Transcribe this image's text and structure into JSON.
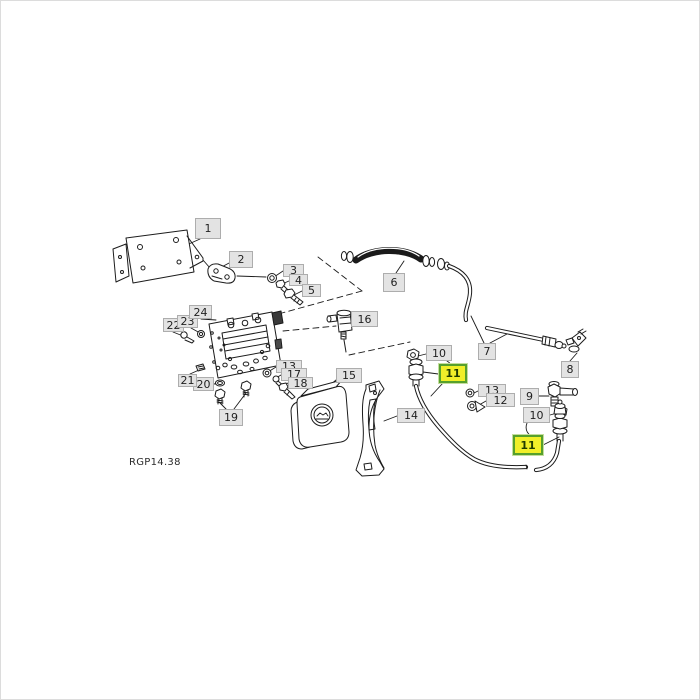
{
  "figure": {
    "code": "RGP14.38",
    "type": "exploded-parts-diagram",
    "colors": {
      "line": "#1c1c1c",
      "label_bg": "#e3e3e3",
      "label_border": "#adadad",
      "label_text": "#1f1f1f",
      "highlight_bg": "#f1ef29",
      "highlight_border": "#56a02c",
      "highlight_halo": "#c4dd9d",
      "highlight_text": "#1e3b00"
    },
    "labels": [
      {
        "text": "1",
        "x": 195,
        "y": 218,
        "w": 26,
        "h": 21,
        "highlighted": false
      },
      {
        "text": "2",
        "x": 229,
        "y": 251,
        "w": 24,
        "h": 17,
        "highlighted": false
      },
      {
        "text": "3",
        "x": 283,
        "y": 264,
        "w": 21,
        "h": 13,
        "highlighted": false
      },
      {
        "text": "4",
        "x": 289,
        "y": 274,
        "w": 19,
        "h": 12,
        "highlighted": false
      },
      {
        "text": "5",
        "x": 302,
        "y": 284,
        "w": 19,
        "h": 13,
        "highlighted": false
      },
      {
        "text": "6",
        "x": 383,
        "y": 273,
        "w": 22,
        "h": 19,
        "highlighted": false
      },
      {
        "text": "7",
        "x": 478,
        "y": 343,
        "w": 18,
        "h": 17,
        "highlighted": false
      },
      {
        "text": "8",
        "x": 561,
        "y": 361,
        "w": 18,
        "h": 17,
        "highlighted": false
      },
      {
        "text": "9",
        "x": 520,
        "y": 388,
        "w": 19,
        "h": 17,
        "highlighted": false
      },
      {
        "text": "10",
        "x": 426,
        "y": 345,
        "w": 26,
        "h": 16,
        "highlighted": false
      },
      {
        "text": "11",
        "x": 439,
        "y": 364,
        "w": 28,
        "h": 19,
        "highlighted": true
      },
      {
        "text": "13",
        "x": 478,
        "y": 384,
        "w": 28,
        "h": 13,
        "highlighted": false
      },
      {
        "text": "12",
        "x": 486,
        "y": 393,
        "w": 29,
        "h": 14,
        "highlighted": false
      },
      {
        "text": "10",
        "x": 523,
        "y": 407,
        "w": 27,
        "h": 16,
        "highlighted": false
      },
      {
        "text": "11",
        "x": 513,
        "y": 435,
        "w": 30,
        "h": 20,
        "highlighted": true
      },
      {
        "text": "13",
        "x": 276,
        "y": 360,
        "w": 26,
        "h": 13,
        "highlighted": false
      },
      {
        "text": "17",
        "x": 281,
        "y": 368,
        "w": 26,
        "h": 13,
        "highlighted": false
      },
      {
        "text": "18",
        "x": 288,
        "y": 377,
        "w": 25,
        "h": 12,
        "highlighted": false
      },
      {
        "text": "14",
        "x": 397,
        "y": 408,
        "w": 28,
        "h": 15,
        "highlighted": false
      },
      {
        "text": "15",
        "x": 336,
        "y": 368,
        "w": 26,
        "h": 15,
        "highlighted": false
      },
      {
        "text": "16",
        "x": 351,
        "y": 311,
        "w": 27,
        "h": 16,
        "highlighted": false
      },
      {
        "text": "19",
        "x": 219,
        "y": 409,
        "w": 24,
        "h": 17,
        "highlighted": false
      },
      {
        "text": "20",
        "x": 193,
        "y": 377,
        "w": 21,
        "h": 14,
        "highlighted": false
      },
      {
        "text": "21",
        "x": 178,
        "y": 374,
        "w": 19,
        "h": 13,
        "highlighted": false
      },
      {
        "text": "22",
        "x": 163,
        "y": 318,
        "w": 21,
        "h": 14,
        "highlighted": false
      },
      {
        "text": "23",
        "x": 177,
        "y": 315,
        "w": 21,
        "h": 13,
        "highlighted": false
      },
      {
        "text": "24",
        "x": 189,
        "y": 305,
        "w": 23,
        "h": 14,
        "highlighted": false
      }
    ]
  }
}
